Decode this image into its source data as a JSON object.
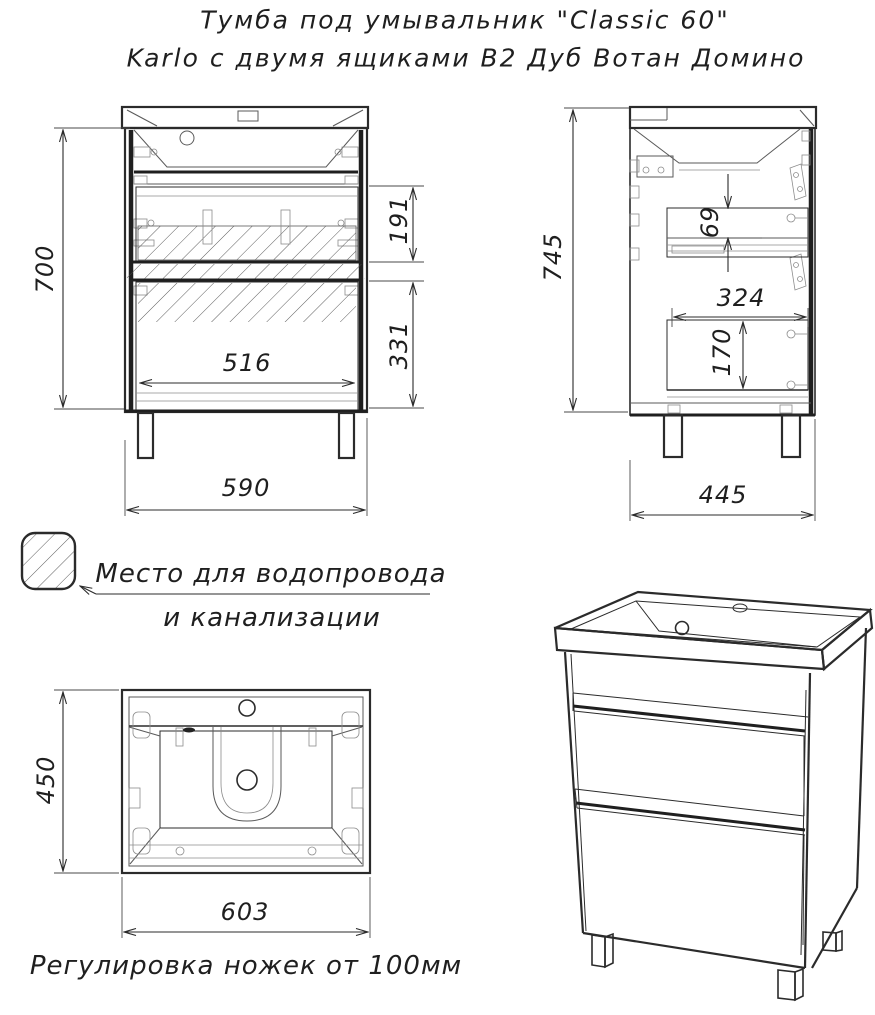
{
  "title": {
    "line1": "Тумба под умывальник \"Classic 60\"",
    "line2": "Karlo с двумя ящиками В2 Дуб Вотан Домино"
  },
  "views": {
    "front": {
      "height": "700",
      "drawer1_inner": "191",
      "drawer2_inner": "331",
      "inner_width": "516",
      "width": "590"
    },
    "side": {
      "height": "745",
      "rail_offset": "69",
      "inner_depth": "324",
      "drawer_inner": "170",
      "depth": "445"
    },
    "top": {
      "depth": "450",
      "width": "603"
    }
  },
  "legend": {
    "symbol": "diagonal-hatch-square",
    "line1": "Место для водопровода",
    "line2": "и канализации"
  },
  "note": {
    "text": "Регулировка ножек от 100мм"
  },
  "colors": {
    "line": "#2b2b2b",
    "hatch": "#4a4a4a",
    "background": "#ffffff"
  }
}
